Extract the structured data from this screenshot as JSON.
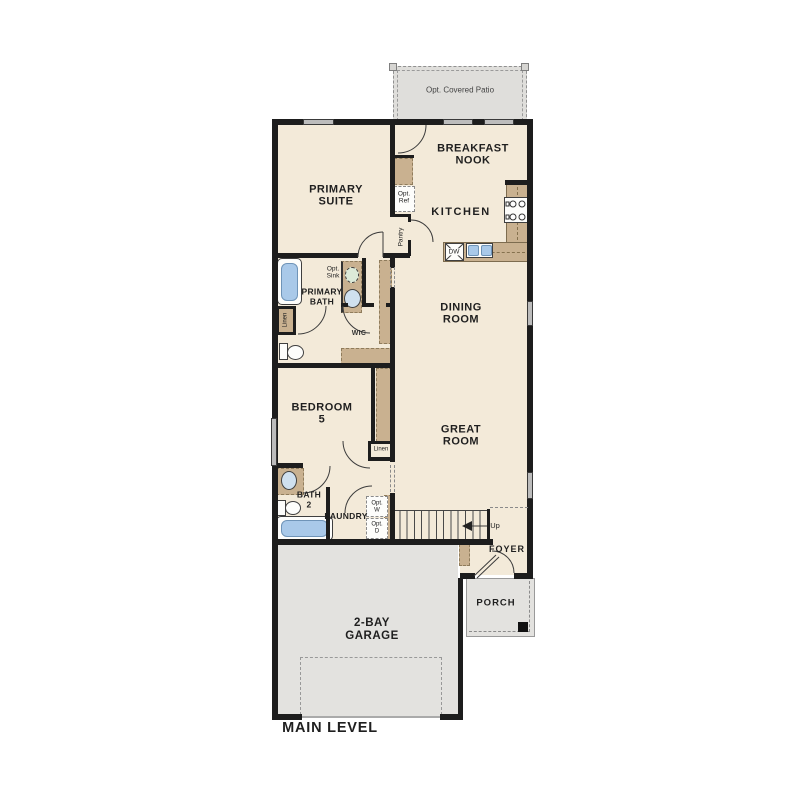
{
  "plan_title": "MAIN LEVEL",
  "colors": {
    "floor": "#f3ead9",
    "wall": "#1d1d1d",
    "counter_tan": "#c9b190",
    "water_blue": "#a9c9e9",
    "outdoor_gray": "#e3e2df",
    "window_gray": "#bcbcbc"
  },
  "labels": {
    "patio": "Opt. Covered Patio",
    "primary_suite": "PRIMARY\nSUITE",
    "breakfast_nook": "BREAKFAST\nNOOK",
    "kitchen": "KITCHEN",
    "opt_ref": "Opt.\nRef",
    "pantry": "Pantry",
    "dishwasher": "DW",
    "dining_room": "DINING\nROOM",
    "great_room": "GREAT\nROOM",
    "primary_bath": "PRIMARY\nBATH",
    "opt_sink": "Opt.\nSink",
    "linen_primary": "Linen",
    "wic": "WIC",
    "bedroom_5": "BEDROOM\n5",
    "linen_hall": "Linen",
    "bath_2": "BATH\n2",
    "laundry": "LAUNDRY",
    "opt_washer": "Opt.\nW",
    "opt_dryer": "Opt.\nD",
    "stairs_up": "Up",
    "foyer": "FOYER",
    "porch": "PORCH",
    "garage": "2-BAY\nGARAGE"
  }
}
